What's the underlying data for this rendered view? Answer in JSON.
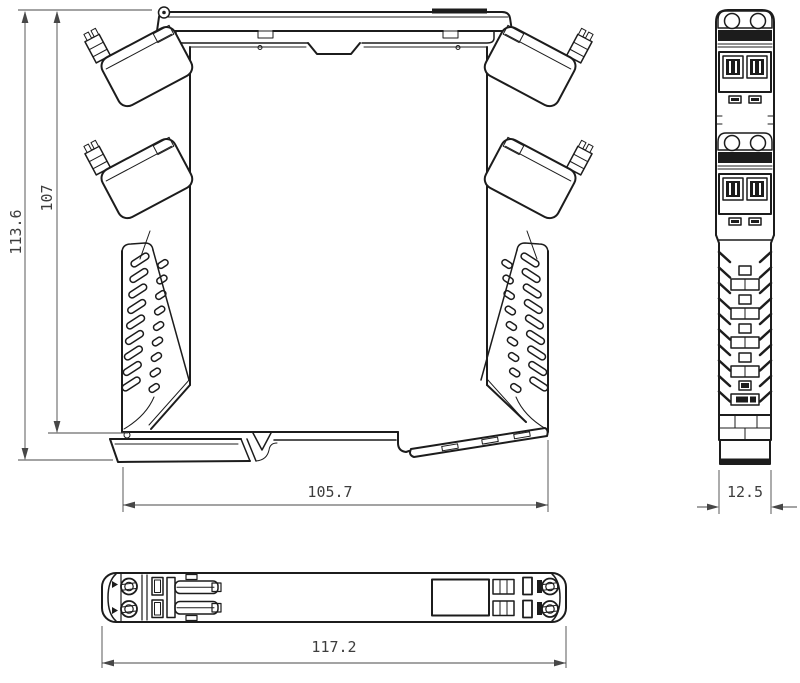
{
  "drawing": {
    "background_color": "#ffffff",
    "line_color": "#1c1c1c",
    "dimension_color": "#3d3d3d",
    "dimensions": {
      "overall_height": "113.6",
      "housing_height": "107",
      "housing_width": "105.7",
      "module_width": "12.5",
      "overall_length": "117.2"
    }
  }
}
